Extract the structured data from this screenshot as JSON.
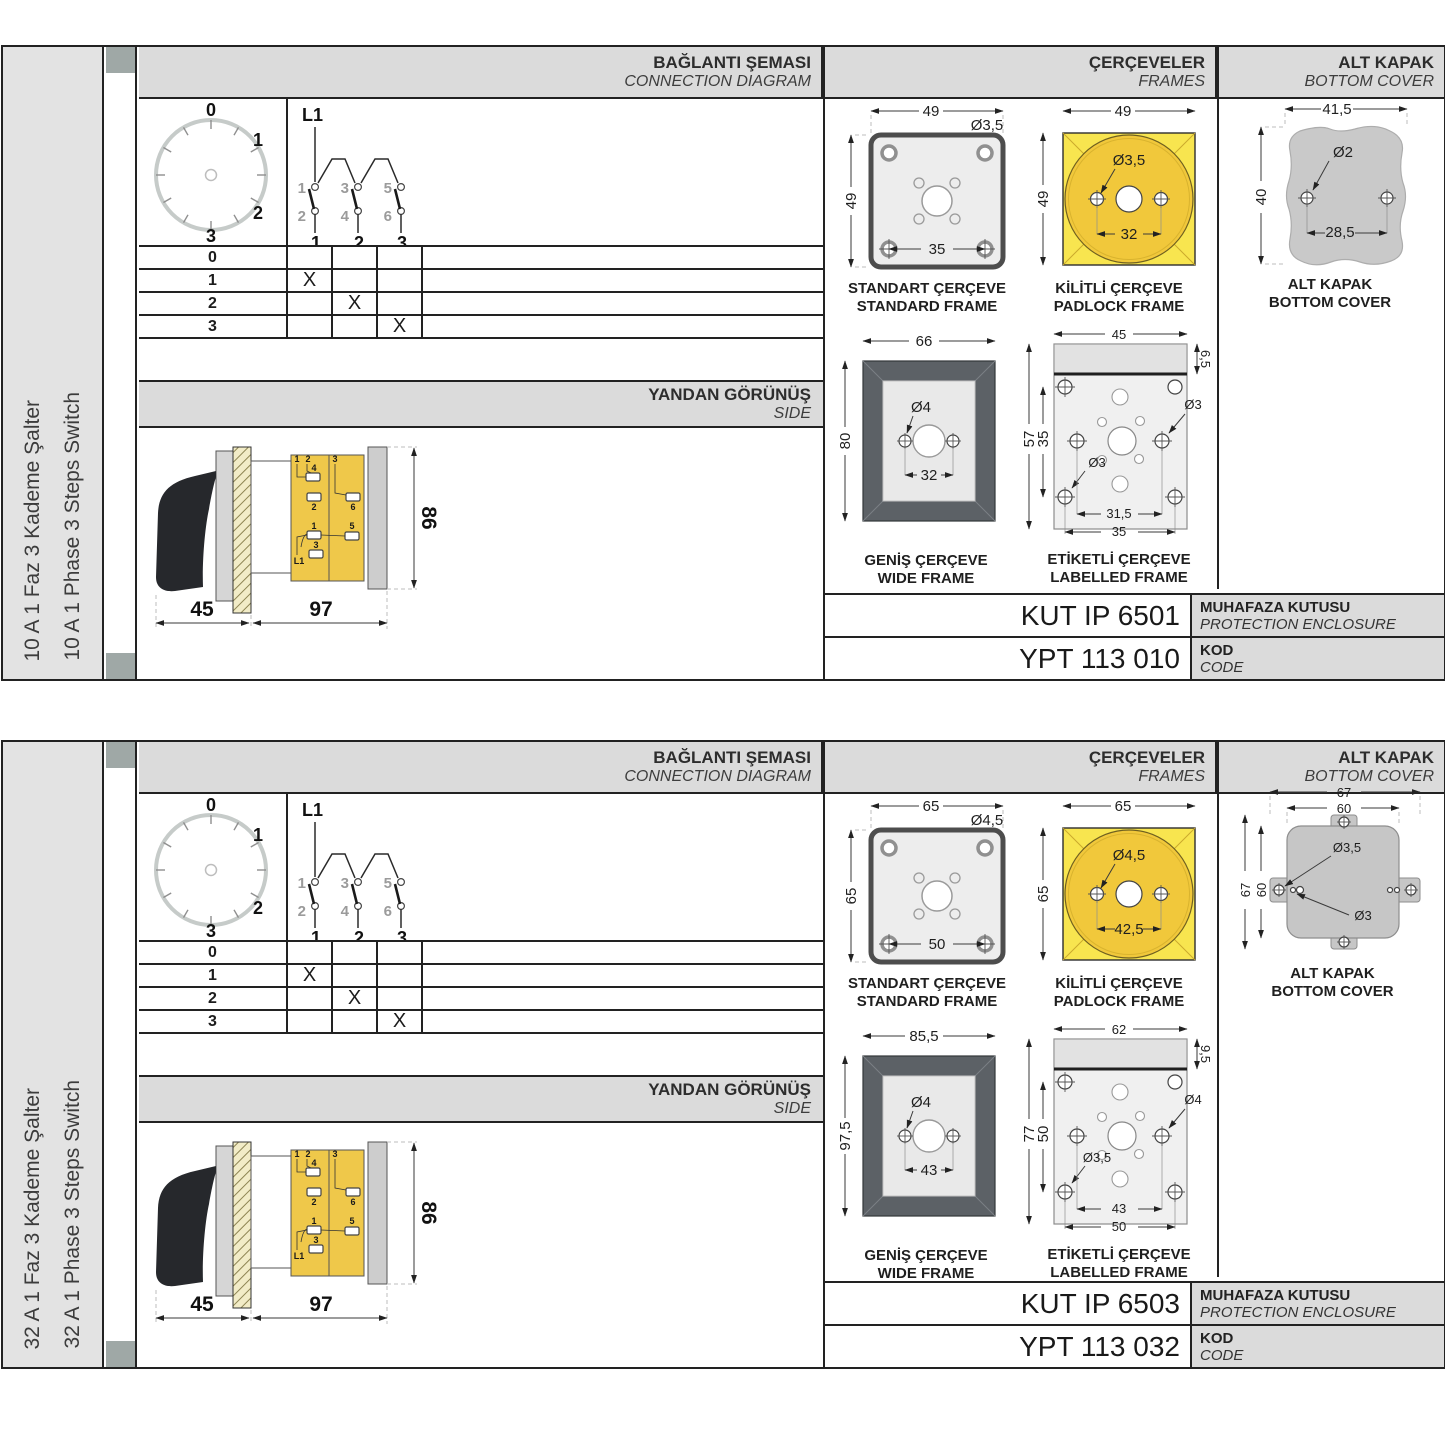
{
  "colors": {
    "header_bg": "#dbdbdb",
    "sidebar_bg": "#e3e3e3",
    "gutter_square": "#9fa8a6",
    "padlock_square_yellow": "#f8e54f",
    "padlock_circle_yellow": "#f1c83b",
    "side_body_yellow": "#efc84a",
    "wide_frame_gray": "#5c6166",
    "cover_gray": "#c9c9c9",
    "line_dark": "#222222"
  },
  "sections": [
    {
      "sidebar": {
        "label_tr": "10 A 1 Faz 3 Kademe Şalter",
        "label_en": "10 A 1 Phase 3 Steps Switch"
      },
      "headers": {
        "connection_tr": "BAĞLANTI ŞEMASI",
        "connection_en": "CONNECTION DIAGRAM",
        "frames_tr": "ÇERÇEVELER",
        "frames_en": "FRAMES",
        "cover_tr": "ALT KAPAK",
        "cover_en": "BOTTOM COVER"
      },
      "dial": {
        "p0": "0",
        "p1": "1",
        "p2": "2",
        "p3": "3"
      },
      "circuit": {
        "phase": "L1",
        "top_contacts": [
          "1",
          "3",
          "5"
        ],
        "bottom_contacts": [
          "2",
          "4",
          "6"
        ],
        "terminals": [
          "1",
          "2",
          "3"
        ]
      },
      "switch_table": {
        "rows": [
          "0",
          "1",
          "2",
          "3"
        ],
        "mark": "X"
      },
      "side_view": {
        "header_tr": "YANDAN GÖRÜNÜŞ",
        "header_en": "SIDE",
        "dim_front": "45",
        "dim_body": "97",
        "dim_height": "86",
        "terminal_labels": [
          "1",
          "2",
          "4",
          "2",
          "3",
          "6",
          "1",
          "5",
          "3",
          "L1"
        ]
      },
      "frames": {
        "standard": {
          "caption_tr": "STANDART ÇERÇEVE",
          "caption_en": "STANDARD FRAME",
          "dim_width": "49",
          "dim_height": "49",
          "dim_hole": "Ø3,5",
          "dim_inner": "35"
        },
        "padlock": {
          "caption_tr": "KİLİTLİ ÇERÇEVE",
          "caption_en": "PADLOCK FRAME",
          "dim_width": "49",
          "dim_height": "49",
          "dim_hole": "Ø3,5",
          "dim_inner": "32"
        },
        "wide": {
          "caption_tr": "GENİŞ ÇERÇEVE",
          "caption_en": "WIDE FRAME",
          "dim_width": "66",
          "dim_height": "80",
          "dim_hole": "Ø4",
          "dim_inner": "32"
        },
        "labelled": {
          "caption_tr": "ETİKETLİ ÇERÇEVE",
          "caption_en": "LABELLED FRAME",
          "dim_width": "45",
          "dim_band": "6,5",
          "dim_height": "57",
          "dim_inner_height": "35",
          "dim_hole_right": "Ø3",
          "dim_hole_left": "Ø3",
          "dim_bottom_inner": "31,5",
          "dim_bottom_outer": "35"
        }
      },
      "cover": {
        "caption_tr": "ALT KAPAK",
        "caption_en": "BOTTOM COVER",
        "dim_width": "41,5",
        "dim_hole": "Ø2",
        "dim_height": "40",
        "dim_inner": "28,5"
      },
      "codes": {
        "enclosure_value": "KUT IP 6501",
        "enclosure_tr": "MUHAFAZA KUTUSU",
        "enclosure_en": "PROTECTION ENCLOSURE",
        "code_value": "YPT 113 010",
        "code_tr": "KOD",
        "code_en": "CODE"
      }
    },
    {
      "sidebar": {
        "label_tr": "32 A 1 Faz 3 Kademe Şalter",
        "label_en": "32 A 1 Phase 3 Steps Switch"
      },
      "headers": {
        "connection_tr": "BAĞLANTI ŞEMASI",
        "connection_en": "CONNECTION DIAGRAM",
        "frames_tr": "ÇERÇEVELER",
        "frames_en": "FRAMES",
        "cover_tr": "ALT KAPAK",
        "cover_en": "BOTTOM COVER"
      },
      "dial": {
        "p0": "0",
        "p1": "1",
        "p2": "2",
        "p3": "3"
      },
      "circuit": {
        "phase": "L1",
        "top_contacts": [
          "1",
          "3",
          "5"
        ],
        "bottom_contacts": [
          "2",
          "4",
          "6"
        ],
        "terminals": [
          "1",
          "2",
          "3"
        ]
      },
      "switch_table": {
        "rows": [
          "0",
          "1",
          "2",
          "3"
        ],
        "mark": "X"
      },
      "side_view": {
        "header_tr": "YANDAN GÖRÜNÜŞ",
        "header_en": "SIDE",
        "dim_front": "45",
        "dim_body": "97",
        "dim_height": "86",
        "terminal_labels": [
          "1",
          "2",
          "4",
          "2",
          "3",
          "6",
          "1",
          "5",
          "3",
          "L1"
        ]
      },
      "frames": {
        "standard": {
          "caption_tr": "STANDART ÇERÇEVE",
          "caption_en": "STANDARD FRAME",
          "dim_width": "65",
          "dim_height": "65",
          "dim_hole": "Ø4,5",
          "dim_inner": "50"
        },
        "padlock": {
          "caption_tr": "KİLİTLİ ÇERÇEVE",
          "caption_en": "PADLOCK FRAME",
          "dim_width": "65",
          "dim_height": "65",
          "dim_hole": "Ø4,5",
          "dim_inner": "42,5"
        },
        "wide": {
          "caption_tr": "GENİŞ ÇERÇEVE",
          "caption_en": "WIDE FRAME",
          "dim_width": "85,5",
          "dim_height": "97,5",
          "dim_hole": "Ø4",
          "dim_inner": "43"
        },
        "labelled": {
          "caption_tr": "ETİKETLİ ÇERÇEVE",
          "caption_en": "LABELLED FRAME",
          "dim_width": "62",
          "dim_band": "9,5",
          "dim_height": "77",
          "dim_inner_height": "50",
          "dim_hole_right": "Ø4",
          "dim_hole_left": "Ø3,5",
          "dim_bottom_inner": "43",
          "dim_bottom_outer": "50"
        }
      },
      "cover": {
        "caption_tr": "ALT KAPAK",
        "caption_en": "BOTTOM COVER",
        "dim_width_outer": "67",
        "dim_width_inner": "60",
        "dim_height_outer": "67",
        "dim_height_inner": "60",
        "dim_hole_big": "Ø3,5",
        "dim_hole_small": "Ø3"
      },
      "codes": {
        "enclosure_value": "KUT IP 6503",
        "enclosure_tr": "MUHAFAZA KUTUSU",
        "enclosure_en": "PROTECTION ENCLOSURE",
        "code_value": "YPT 113 032",
        "code_tr": "KOD",
        "code_en": "CODE"
      }
    }
  ]
}
